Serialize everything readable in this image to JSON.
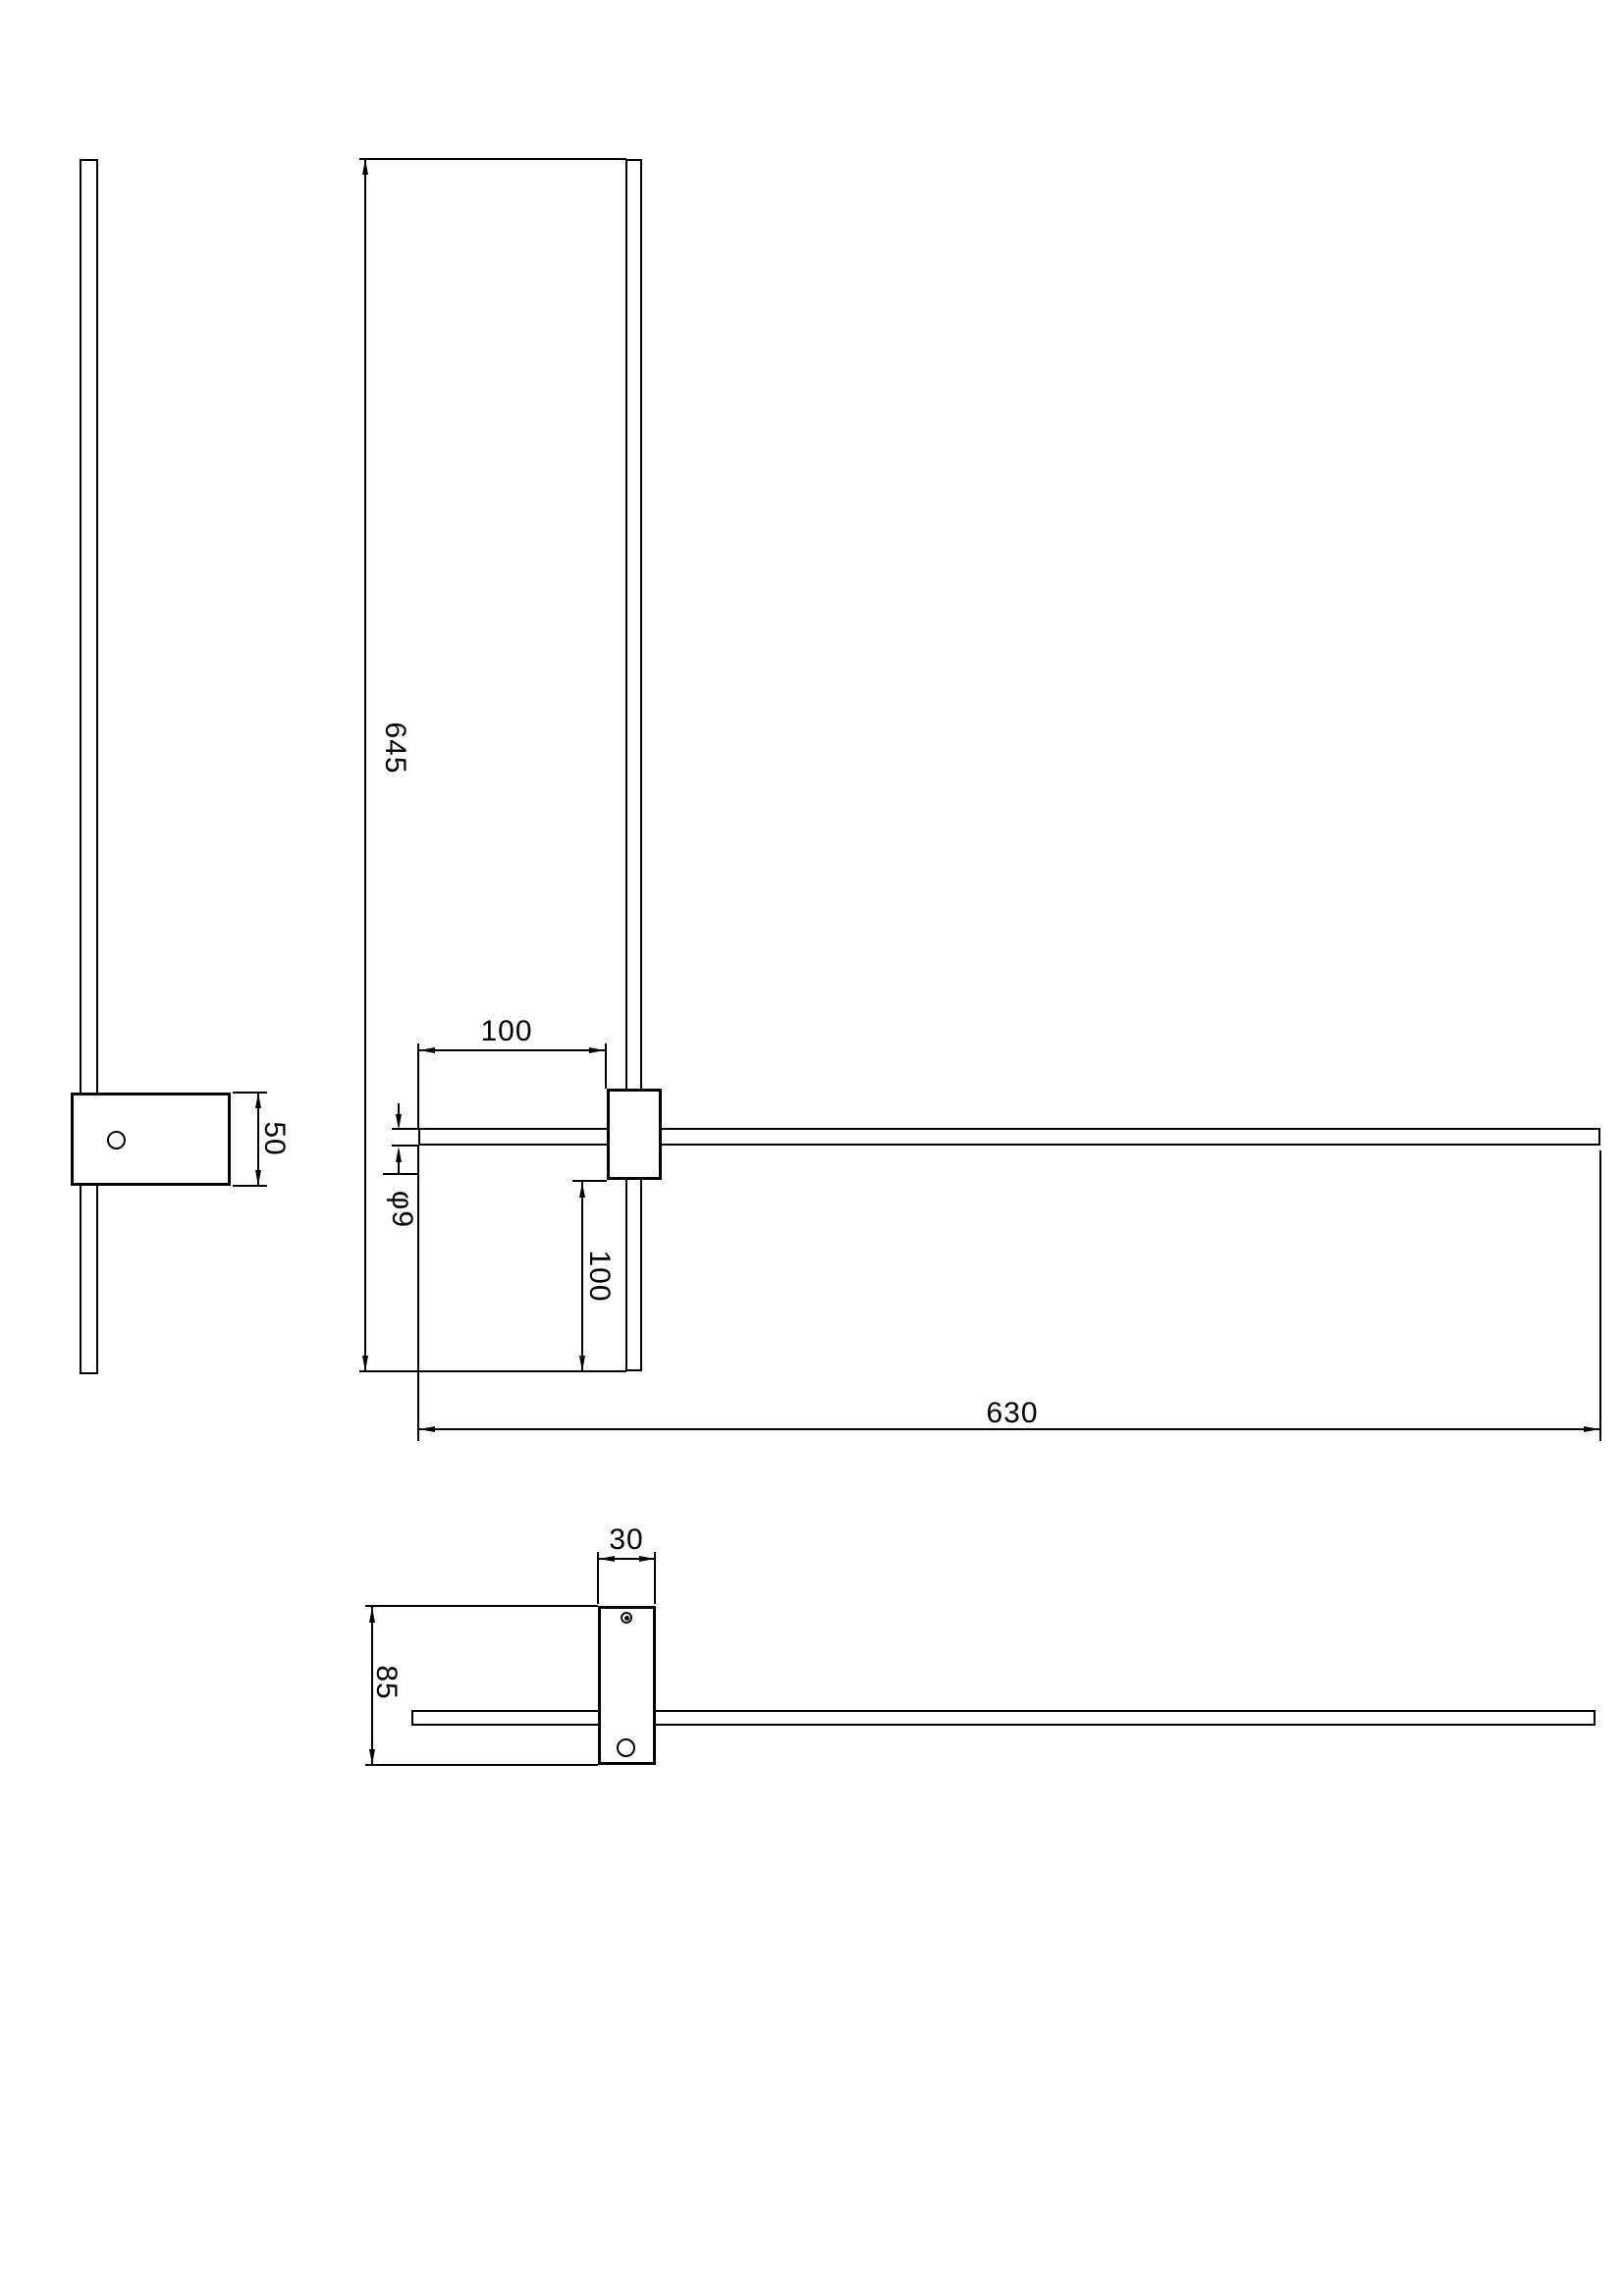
{
  "drawing": {
    "kind": "technical-dimension-drawing",
    "background_color": "#ffffff",
    "line_color": "#000000",
    "dimensions": {
      "vertical_bar_length": "645",
      "horizontal_offset_top": "100",
      "bar_diameter": "φ9",
      "vertical_offset_bottom": "100",
      "horizontal_bar_length": "630",
      "side_bracket_height": "50",
      "bottom_bracket_width": "30",
      "bottom_bracket_depth": "85"
    }
  }
}
